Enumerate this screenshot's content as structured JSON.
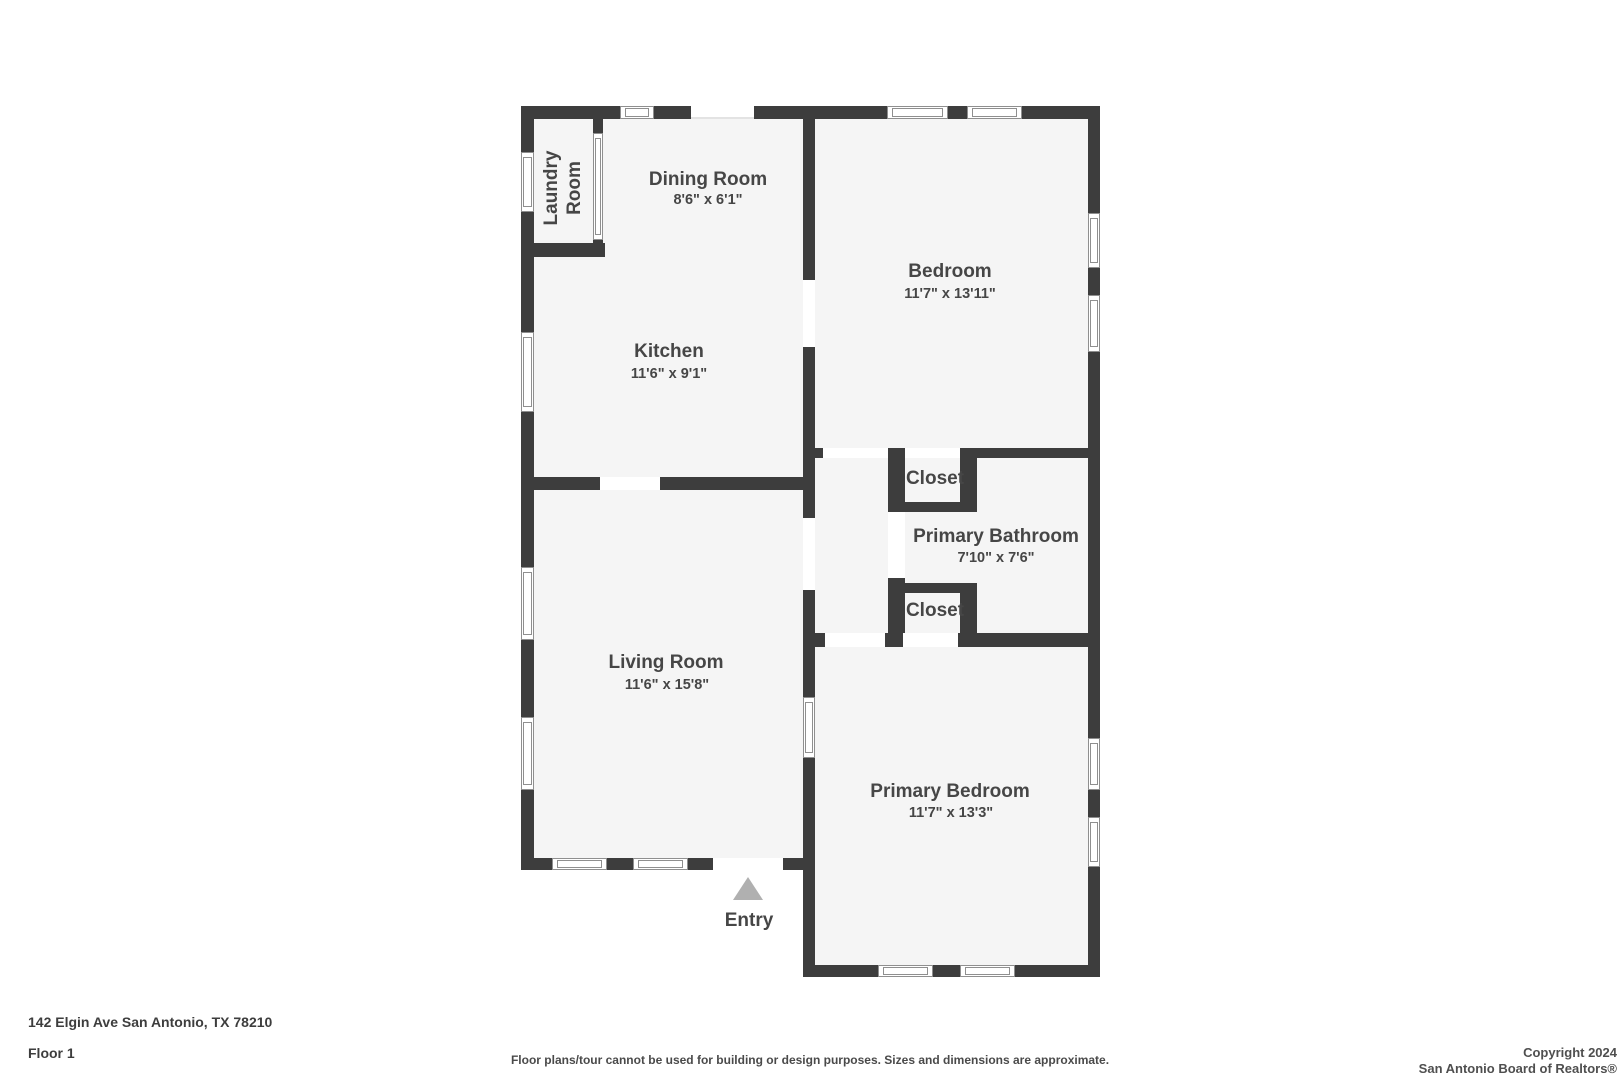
{
  "plan": {
    "rooms": [
      {
        "id": "laundry",
        "name": "Laundry Room",
        "dims": ""
      },
      {
        "id": "dining",
        "name": "Dining Room",
        "dims": "8'6\" x 6'1\""
      },
      {
        "id": "kitchen",
        "name": "Kitchen",
        "dims": "11'6\" x 9'1\""
      },
      {
        "id": "bedroom",
        "name": "Bedroom",
        "dims": "11'7\" x 13'11\""
      },
      {
        "id": "closet-top",
        "name": "Closet",
        "dims": ""
      },
      {
        "id": "bathroom",
        "name": "Primary Bathroom",
        "dims": "7'10\" x 7'6\""
      },
      {
        "id": "closet-bottom",
        "name": "Closet",
        "dims": ""
      },
      {
        "id": "living",
        "name": "Living Room",
        "dims": "11'6\" x 15'8\""
      },
      {
        "id": "primary-bedroom",
        "name": "Primary Bedroom",
        "dims": "11'7\" x 13'3\""
      }
    ],
    "entry_label": "Entry"
  },
  "footer": {
    "address": "142 Elgin Ave San Antonio, TX 78210",
    "floor": "Floor 1",
    "disclaimer": "Floor plans/tour cannot be used for building or design purposes. Sizes and dimensions are approximate.",
    "copyright_line1": "Copyright 2024",
    "copyright_line2": "San Antonio Board of Realtors®"
  },
  "colors": {
    "wall": "#3d3d3d",
    "floor": "#f5f5f5",
    "label": "#464646",
    "entry_arrow": "#b0b0b0"
  }
}
